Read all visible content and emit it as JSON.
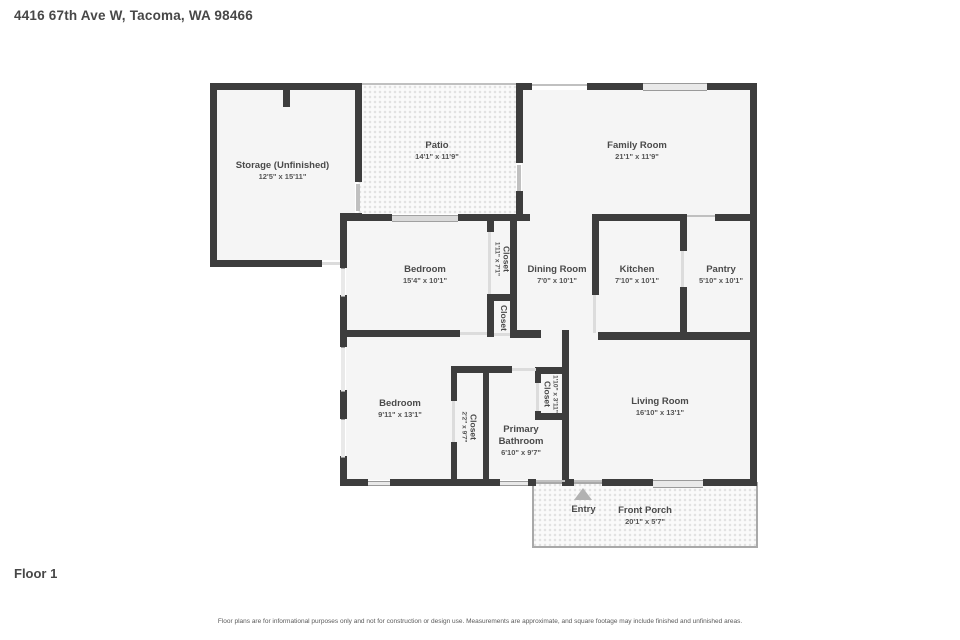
{
  "title": "4416 67th Ave W, Tacoma, WA 98466",
  "floor_label": "Floor 1",
  "disclaimer": "Floor plans are for informational purposes only and not for construction or design use. Measurements are approximate, and square footage may include finished and unfinished areas.",
  "colors": {
    "wall": "#3d3d3d",
    "room_fill": "#f5f5f5",
    "opening": "#dcdcdc",
    "text": "#4a4a4a"
  },
  "rooms": {
    "storage": {
      "name": "Storage (Unfinished)",
      "dims": "12'5\" x 15'11\""
    },
    "patio": {
      "name": "Patio",
      "dims": "14'1\" x 11'9\""
    },
    "family_room": {
      "name": "Family Room",
      "dims": "21'1\" x 11'9\""
    },
    "bedroom_upper": {
      "name": "Bedroom",
      "dims": "15'4\" x 10'1\""
    },
    "closet_hall_upper": {
      "name": "Closet",
      "dims": "1'11\" x 7'1\""
    },
    "closet_hall_lower": {
      "name": "Closet",
      "dims": ""
    },
    "dining_room": {
      "name": "Dining Room",
      "dims": "7'0\" x 10'1\""
    },
    "kitchen": {
      "name": "Kitchen",
      "dims": "7'10\" x 10'1\""
    },
    "pantry": {
      "name": "Pantry",
      "dims": "5'10\" x 10'1\""
    },
    "bedroom_lower": {
      "name": "Bedroom",
      "dims": "9'11\" x 13'1\""
    },
    "closet_bedroom": {
      "name": "Closet",
      "dims": "2'2\" x 9'7\""
    },
    "primary_bathroom": {
      "name": "Primary Bathroom",
      "dims": "6'10\" x 9'7\""
    },
    "closet_bathroom": {
      "name": "Closet",
      "dims": "1'10\" x 3'11\""
    },
    "living_room": {
      "name": "Living Room",
      "dims": "16'10\" x 13'1\""
    },
    "entry": {
      "name": "Entry"
    },
    "front_porch": {
      "name": "Front Porch",
      "dims": "20'1\" x 5'7\""
    }
  }
}
